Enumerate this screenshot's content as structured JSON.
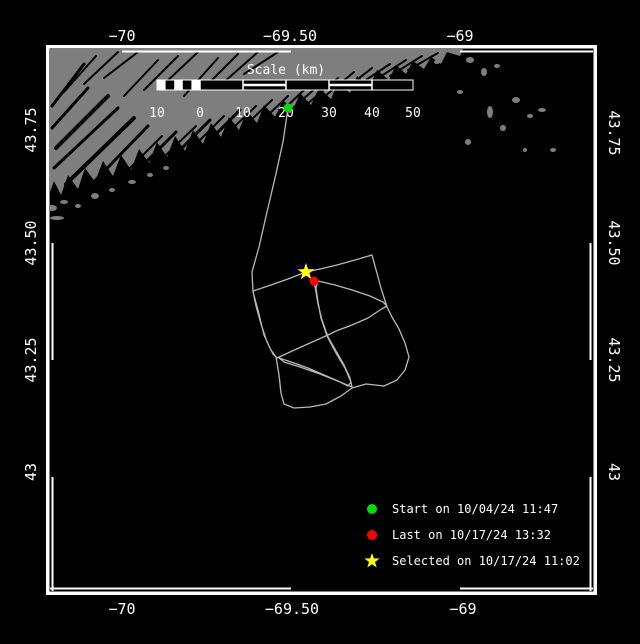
{
  "colors": {
    "background": "#000000",
    "sea": "#000000",
    "land": "#7e7e7e",
    "frame": "#ffffff",
    "track": "#b9b9b9",
    "text": "#ffffff",
    "start": "#00dd00",
    "last": "#ff0000",
    "selected": "#ffff00"
  },
  "axes": {
    "top": [
      {
        "label": "−70",
        "x": 122
      },
      {
        "label": "−69.50",
        "x": 290
      },
      {
        "label": "−69",
        "x": 460
      }
    ],
    "bottom": [
      {
        "label": "−70",
        "x": 122
      },
      {
        "label": "−69.50",
        "x": 292
      },
      {
        "label": "−69",
        "x": 463
      }
    ],
    "left": [
      {
        "label": "43.75",
        "y": 130
      },
      {
        "label": "43.50",
        "y": 243
      },
      {
        "label": "43.25",
        "y": 360
      },
      {
        "label": "43",
        "y": 472
      }
    ],
    "right": [
      {
        "label": "43.75",
        "y": 133
      },
      {
        "label": "43.50",
        "y": 243
      },
      {
        "label": "43.25",
        "y": 360
      },
      {
        "label": "43",
        "y": 472
      }
    ]
  },
  "scale_bar": {
    "title": "Scale (km)",
    "title_x": 286,
    "title_y": 74,
    "x": 157,
    "y": 80,
    "width": 256,
    "height": 10,
    "tick_xs": [
      157,
      200,
      243,
      286,
      329,
      372,
      413
    ],
    "tick_labels": [
      "10",
      "0",
      "10",
      "20",
      "30",
      "40",
      "50"
    ],
    "label_y": 117,
    "subcells": 5,
    "striped_segments": [
      [
        243,
        286
      ],
      [
        329,
        372
      ]
    ]
  },
  "legend": {
    "marker_x": 372,
    "text_x": 392,
    "rows_y": [
      509,
      535,
      561
    ],
    "items": [
      {
        "marker": "circle",
        "color_key": "start",
        "label": "Start on 10/04/24 11:47"
      },
      {
        "marker": "circle",
        "color_key": "last",
        "label": "Last on 10/17/24 13:32"
      },
      {
        "marker": "star",
        "color_key": "selected",
        "label": "Selected on 10/17/24 11:02"
      }
    ]
  },
  "markers": {
    "start": {
      "x": 288,
      "y": 108
    },
    "last": {
      "x": 314,
      "y": 281
    },
    "selected": {
      "x": 306,
      "y": 272
    }
  },
  "track": {
    "points": [
      [
        288,
        108
      ],
      [
        283,
        142
      ],
      [
        275,
        178
      ],
      [
        267,
        212
      ],
      [
        259,
        247
      ],
      [
        252,
        272
      ],
      [
        253,
        292
      ],
      [
        258,
        310
      ],
      [
        264,
        335
      ],
      [
        271,
        350
      ],
      [
        276,
        357
      ],
      [
        279,
        375
      ],
      [
        281,
        393
      ],
      [
        284,
        404
      ],
      [
        294,
        408
      ],
      [
        310,
        407
      ],
      [
        326,
        404
      ],
      [
        341,
        396
      ],
      [
        352,
        388
      ],
      [
        366,
        384
      ],
      [
        384,
        386
      ],
      [
        397,
        380
      ],
      [
        405,
        370
      ],
      [
        409,
        357
      ],
      [
        405,
        343
      ],
      [
        399,
        329
      ],
      [
        392,
        317
      ],
      [
        387,
        307
      ],
      [
        381,
        288
      ],
      [
        375,
        266
      ],
      [
        372,
        255
      ],
      [
        355,
        260
      ],
      [
        337,
        265
      ],
      [
        320,
        269
      ],
      [
        306,
        272
      ],
      [
        288,
        279
      ],
      [
        268,
        286
      ],
      [
        253,
        291
      ],
      [
        256,
        306
      ],
      [
        261,
        324
      ],
      [
        267,
        342
      ],
      [
        273,
        354
      ],
      [
        277,
        358
      ],
      [
        290,
        352
      ],
      [
        310,
        343
      ],
      [
        328,
        335
      ],
      [
        336,
        331
      ],
      [
        352,
        325
      ],
      [
        368,
        318
      ],
      [
        380,
        310
      ],
      [
        387,
        306
      ],
      [
        383,
        302
      ],
      [
        370,
        296
      ],
      [
        352,
        290
      ],
      [
        335,
        285
      ],
      [
        318,
        281
      ],
      [
        316,
        288
      ],
      [
        318,
        302
      ],
      [
        321,
        318
      ],
      [
        327,
        336
      ],
      [
        336,
        353
      ],
      [
        345,
        368
      ],
      [
        351,
        382
      ],
      [
        348,
        386
      ],
      [
        338,
        381
      ],
      [
        324,
        375
      ],
      [
        308,
        368
      ],
      [
        294,
        363
      ],
      [
        279,
        358
      ],
      [
        284,
        362
      ],
      [
        300,
        367
      ],
      [
        320,
        374
      ],
      [
        340,
        382
      ],
      [
        352,
        387
      ],
      [
        350,
        378
      ],
      [
        344,
        365
      ],
      [
        336,
        351
      ],
      [
        328,
        337
      ],
      [
        322,
        320
      ],
      [
        318,
        304
      ],
      [
        316,
        292
      ],
      [
        314,
        281
      ]
    ]
  },
  "land": {
    "outline": [
      [
        50,
        49
      ],
      [
        463,
        49
      ],
      [
        460,
        56
      ],
      [
        447,
        52
      ],
      [
        441,
        64
      ],
      [
        431,
        57
      ],
      [
        424,
        69
      ],
      [
        413,
        61
      ],
      [
        406,
        74
      ],
      [
        396,
        65
      ],
      [
        389,
        80
      ],
      [
        377,
        70
      ],
      [
        370,
        86
      ],
      [
        357,
        76
      ],
      [
        350,
        93
      ],
      [
        338,
        82
      ],
      [
        331,
        99
      ],
      [
        319,
        88
      ],
      [
        311,
        105
      ],
      [
        300,
        93
      ],
      [
        293,
        110
      ],
      [
        283,
        100
      ],
      [
        275,
        117
      ],
      [
        264,
        105
      ],
      [
        257,
        123
      ],
      [
        247,
        111
      ],
      [
        239,
        130
      ],
      [
        229,
        117
      ],
      [
        221,
        137
      ],
      [
        211,
        123
      ],
      [
        203,
        144
      ],
      [
        193,
        130
      ],
      [
        185,
        151
      ],
      [
        175,
        136
      ],
      [
        167,
        157
      ],
      [
        157,
        142
      ],
      [
        149,
        163
      ],
      [
        139,
        149
      ],
      [
        131,
        170
      ],
      [
        121,
        155
      ],
      [
        113,
        176
      ],
      [
        103,
        161
      ],
      [
        95,
        182
      ],
      [
        85,
        168
      ],
      [
        78,
        189
      ],
      [
        68,
        175
      ],
      [
        61,
        195
      ],
      [
        54,
        181
      ],
      [
        50,
        192
      ]
    ],
    "inlets": [
      [
        56,
        148,
        108,
        96,
        4
      ],
      [
        54,
        168,
        118,
        108,
        3
      ],
      [
        66,
        184,
        134,
        118,
        4
      ],
      [
        86,
        190,
        148,
        126,
        3
      ],
      [
        106,
        192,
        162,
        136,
        2
      ],
      [
        124,
        184,
        176,
        132,
        3
      ],
      [
        142,
        178,
        196,
        126,
        2
      ],
      [
        158,
        172,
        210,
        120,
        3
      ],
      [
        176,
        164,
        224,
        116,
        2
      ],
      [
        192,
        158,
        240,
        110,
        3
      ],
      [
        210,
        150,
        256,
        106,
        2
      ],
      [
        228,
        142,
        272,
        100,
        2
      ],
      [
        246,
        136,
        288,
        96,
        2
      ],
      [
        264,
        128,
        304,
        90,
        2
      ],
      [
        282,
        118,
        320,
        84,
        2
      ],
      [
        300,
        110,
        338,
        78,
        2
      ],
      [
        318,
        102,
        354,
        72,
        2
      ],
      [
        336,
        96,
        372,
        68,
        2
      ],
      [
        354,
        88,
        390,
        64,
        2
      ],
      [
        372,
        82,
        406,
        60,
        2
      ],
      [
        390,
        76,
        422,
        56,
        2
      ],
      [
        408,
        70,
        438,
        53,
        2
      ],
      [
        52,
        128,
        88,
        88,
        3
      ],
      [
        52,
        106,
        84,
        64,
        3
      ],
      [
        64,
        92,
        96,
        56,
        2
      ],
      [
        84,
        84,
        118,
        52,
        2
      ],
      [
        104,
        78,
        138,
        52,
        2
      ],
      [
        124,
        96,
        158,
        60,
        2
      ],
      [
        144,
        90,
        178,
        56,
        2
      ],
      [
        164,
        84,
        198,
        52,
        2
      ],
      [
        184,
        96,
        218,
        58,
        2
      ],
      [
        204,
        88,
        238,
        54,
        2
      ],
      [
        224,
        82,
        258,
        52,
        2
      ],
      [
        244,
        74,
        278,
        52,
        2
      ]
    ],
    "islands": [
      [
        52,
        208,
        5,
        3
      ],
      [
        64,
        202,
        4,
        2
      ],
      [
        78,
        206,
        3,
        2
      ],
      [
        95,
        196,
        4,
        3
      ],
      [
        112,
        190,
        3,
        2
      ],
      [
        132,
        182,
        4,
        2
      ],
      [
        150,
        175,
        3,
        2
      ],
      [
        166,
        168,
        3,
        2
      ],
      [
        57,
        218,
        7,
        2
      ],
      [
        470,
        60,
        4,
        3
      ],
      [
        484,
        72,
        3,
        4
      ],
      [
        497,
        66,
        3,
        2
      ],
      [
        490,
        112,
        3,
        6
      ],
      [
        503,
        128,
        3,
        3
      ],
      [
        516,
        100,
        4,
        3
      ],
      [
        530,
        116,
        3,
        2
      ],
      [
        542,
        110,
        4,
        2
      ],
      [
        468,
        142,
        3,
        3
      ],
      [
        525,
        150,
        2,
        2
      ],
      [
        553,
        150,
        3,
        2
      ],
      [
        460,
        92,
        3,
        2
      ],
      [
        437,
        62,
        3,
        2
      ]
    ]
  }
}
